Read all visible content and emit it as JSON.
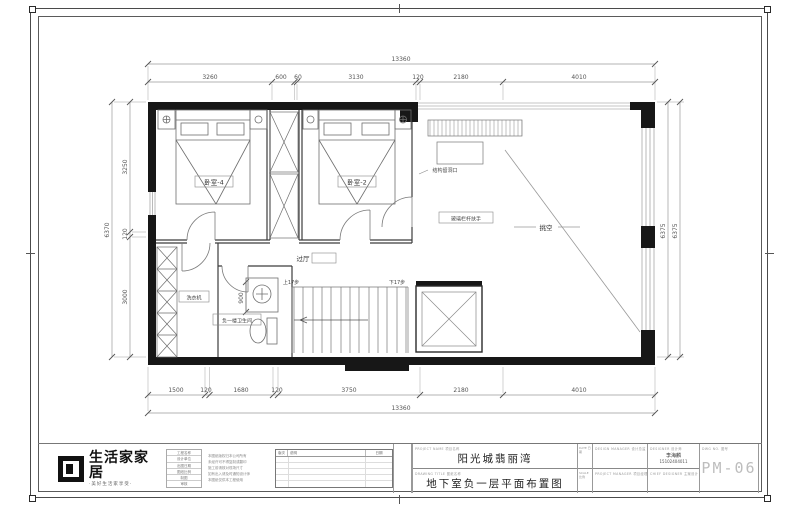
{
  "dims": {
    "top": {
      "overall": "13360",
      "segs": [
        "3260",
        "600",
        "60",
        "3130",
        "120",
        "2180",
        "4010"
      ]
    },
    "bottom": {
      "overall": "13360",
      "segs": [
        "1500",
        "120",
        "1680",
        "120",
        "3750",
        "2180",
        "4010"
      ]
    },
    "left": {
      "overall": "6370",
      "segs": [
        "3250",
        "120",
        "3000"
      ]
    },
    "right": {
      "segs": [
        "6375",
        "6375"
      ]
    },
    "bath": "900"
  },
  "plan": {
    "rooms": {
      "bedroom4": "卧室-4",
      "bedroom2": "卧室-2",
      "void": "挑空",
      "hall": "过厅",
      "bath": "负一楼卫生间",
      "washer": "洗衣机"
    },
    "notes": {
      "opening": "结构留洞口",
      "railing": "玻璃栏杆扶手",
      "stair_up": "上17步",
      "stair_down": "下17步"
    }
  },
  "titleblock": {
    "brand": {
      "name": "生活家家居",
      "slogan": "·美好生活家享受·"
    },
    "info_rows": [
      "工程名称",
      "设计单位",
      "出图日期",
      "图纸比例",
      "制图",
      "审核"
    ],
    "disclaimer": [
      "本图纸版权归本公司所有",
      "未经许可不得复制或翻印",
      "施工前请核对现场尺寸",
      "如有出入请及时通知设计师",
      "本图纸仅供本工程使用"
    ],
    "revision": {
      "col_version": "版次",
      "col_desc": "说明",
      "col_date": "日期"
    },
    "project": {
      "label": "PROJECT NAME 项目名称",
      "value": "阳光城翡丽湾"
    },
    "drawing": {
      "label": "DRAWING TITLE 图纸名称",
      "value": "地下室负一层平面布置图"
    },
    "date_label": "DATE 日期",
    "scale_label": "SCALE 比例",
    "design_manager": "DESIGN MANAGER 设计总监",
    "project_manager": "PROJECT MANAGER 项目经理",
    "designer_label": "DESIGNER 设计师",
    "designer_name": "李海麟",
    "designer_phone": "15102404011",
    "chief_label": "CHIEF DESIGNER 主案设计",
    "dwg_label": "DWG NO. 图号",
    "dwg_no": "PM-06"
  }
}
